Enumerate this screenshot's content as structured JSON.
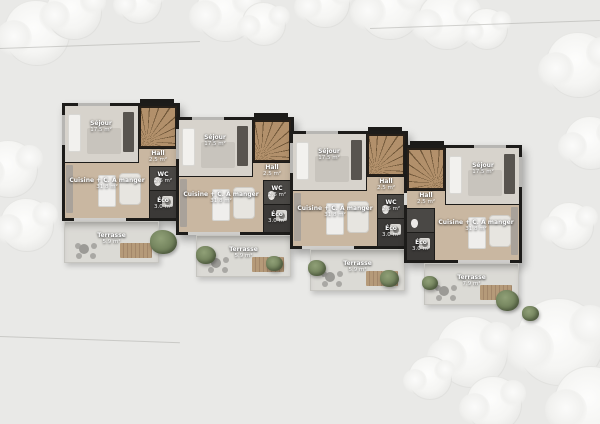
{
  "colors": {
    "background": "#e9e9e7",
    "wall": "#1d1c1a",
    "wood_floor": "#c9b7a1",
    "sejour_floor": "#d7d3cc",
    "dark_room": "#4a4845",
    "darker_room": "#3b3937",
    "terrace": "#dbdad5",
    "stairs_wood": "#b2906b",
    "greenery": "#72825c",
    "label_text": "#ffffff"
  },
  "units": [
    {
      "id": "unit-1",
      "rooms": [
        {
          "key": "sejour",
          "name": "Séjour",
          "area": "17.5 m²"
        },
        {
          "key": "hall",
          "name": "Hall",
          "area": "2.5 m²"
        },
        {
          "key": "wc",
          "name": "WC",
          "area": "2.6 m²"
        },
        {
          "key": "eco",
          "name": "Éco",
          "area": "3.0 m²"
        },
        {
          "key": "cuisine",
          "name": "Cuisine + C. A manger",
          "area": "31.8 m²"
        },
        {
          "key": "terrasse",
          "name": "Terrasse",
          "area": "5.9 m²"
        }
      ]
    },
    {
      "id": "unit-2",
      "rooms": [
        {
          "key": "sejour",
          "name": "Séjour",
          "area": "17.5 m²"
        },
        {
          "key": "hall",
          "name": "Hall",
          "area": "2.5 m²"
        },
        {
          "key": "wc",
          "name": "WC",
          "area": "2.6 m²"
        },
        {
          "key": "eco",
          "name": "Éco",
          "area": "3.0 m²"
        },
        {
          "key": "cuisine",
          "name": "Cuisine + C. A manger",
          "area": "31.8 m²"
        },
        {
          "key": "terrasse",
          "name": "Terrasse",
          "area": "5.9 m²"
        }
      ]
    },
    {
      "id": "unit-3",
      "rooms": [
        {
          "key": "sejour",
          "name": "Séjour",
          "area": "17.5 m²"
        },
        {
          "key": "hall",
          "name": "Hall",
          "area": "2.5 m²"
        },
        {
          "key": "wc",
          "name": "WC",
          "area": "2.6 m²"
        },
        {
          "key": "eco",
          "name": "Éco",
          "area": "3.0 m²"
        },
        {
          "key": "cuisine",
          "name": "Cuisine + C. A manger",
          "area": "31.8 m²"
        },
        {
          "key": "terrasse",
          "name": "Terrasse",
          "area": "5.9 m²"
        }
      ]
    },
    {
      "id": "unit-4",
      "rooms": [
        {
          "key": "sejour",
          "name": "Séjour",
          "area": "17.5 m²"
        },
        {
          "key": "hall",
          "name": "Hall",
          "area": "2.5 m²"
        },
        {
          "key": "eco",
          "name": "Éco",
          "area": "3.0 m²"
        },
        {
          "key": "cuisine",
          "name": "Cuisine + C. A manger",
          "area": "31.8 m²"
        },
        {
          "key": "terrasse",
          "name": "Terrasse",
          "area": "7.9 m²"
        }
      ]
    }
  ]
}
